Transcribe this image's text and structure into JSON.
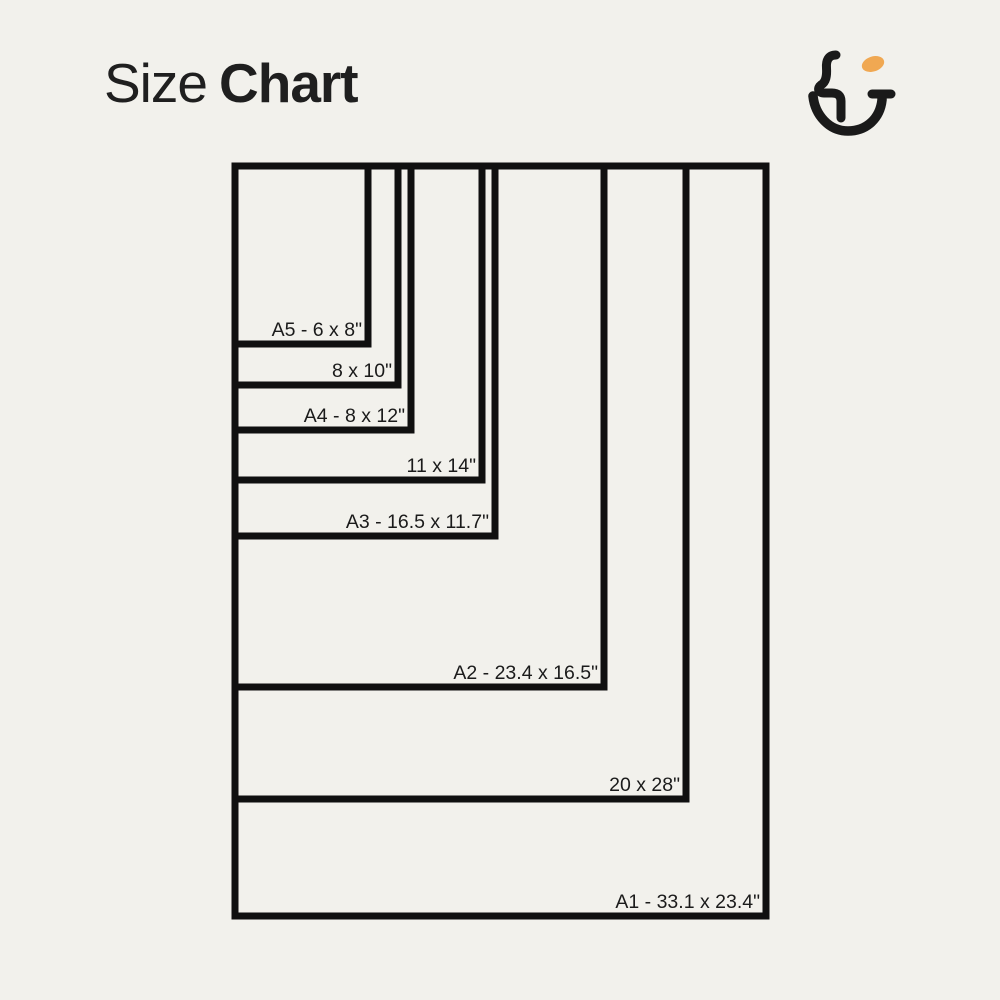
{
  "title": {
    "regular": "Size",
    "bold": "Chart"
  },
  "colors": {
    "background": "#F2F1EC",
    "line": "#101010",
    "label_text": "#1B1B1B",
    "title_text": "#1F1F1F",
    "accent_orange": "#F0A852"
  },
  "logo": {
    "icon": "hu-smile-monogram-icon"
  },
  "chart_data": {
    "type": "diagram-nested-rectangles",
    "title": "Size Chart",
    "unit": "inches",
    "origin_px": {
      "x": 235,
      "y": 166
    },
    "stroke_width_px": 7,
    "label_inset_px": {
      "x": 6,
      "y": 8
    },
    "sizes": [
      {
        "id": "a5",
        "label": "A5 - 6 x 8\"",
        "stated_size_in": "6 x 8",
        "right_px": 368,
        "bottom_px": 344
      },
      {
        "id": "8x10",
        "label": "8 x 10\"",
        "stated_size_in": "8 x 10",
        "right_px": 398,
        "bottom_px": 385
      },
      {
        "id": "a4",
        "label": "A4 - 8 x 12\"",
        "stated_size_in": "8 x 12",
        "right_px": 411,
        "bottom_px": 430
      },
      {
        "id": "11x14",
        "label": "11 x 14\"",
        "stated_size_in": "11 x 14",
        "right_px": 482,
        "bottom_px": 480
      },
      {
        "id": "a3",
        "label": "A3 - 16.5 x 11.7\"",
        "stated_size_in": "16.5 x 11.7",
        "right_px": 495,
        "bottom_px": 536
      },
      {
        "id": "a2",
        "label": "A2 - 23.4 x 16.5\"",
        "stated_size_in": "23.4 x 16.5",
        "right_px": 604,
        "bottom_px": 687
      },
      {
        "id": "20x28",
        "label": "20 x 28\"",
        "stated_size_in": "20 x 28",
        "right_px": 686,
        "bottom_px": 799
      },
      {
        "id": "a1",
        "label": "A1 - 33.1 x 23.4\"",
        "stated_size_in": "33.1 x 23.4",
        "right_px": 766,
        "bottom_px": 916
      }
    ]
  }
}
